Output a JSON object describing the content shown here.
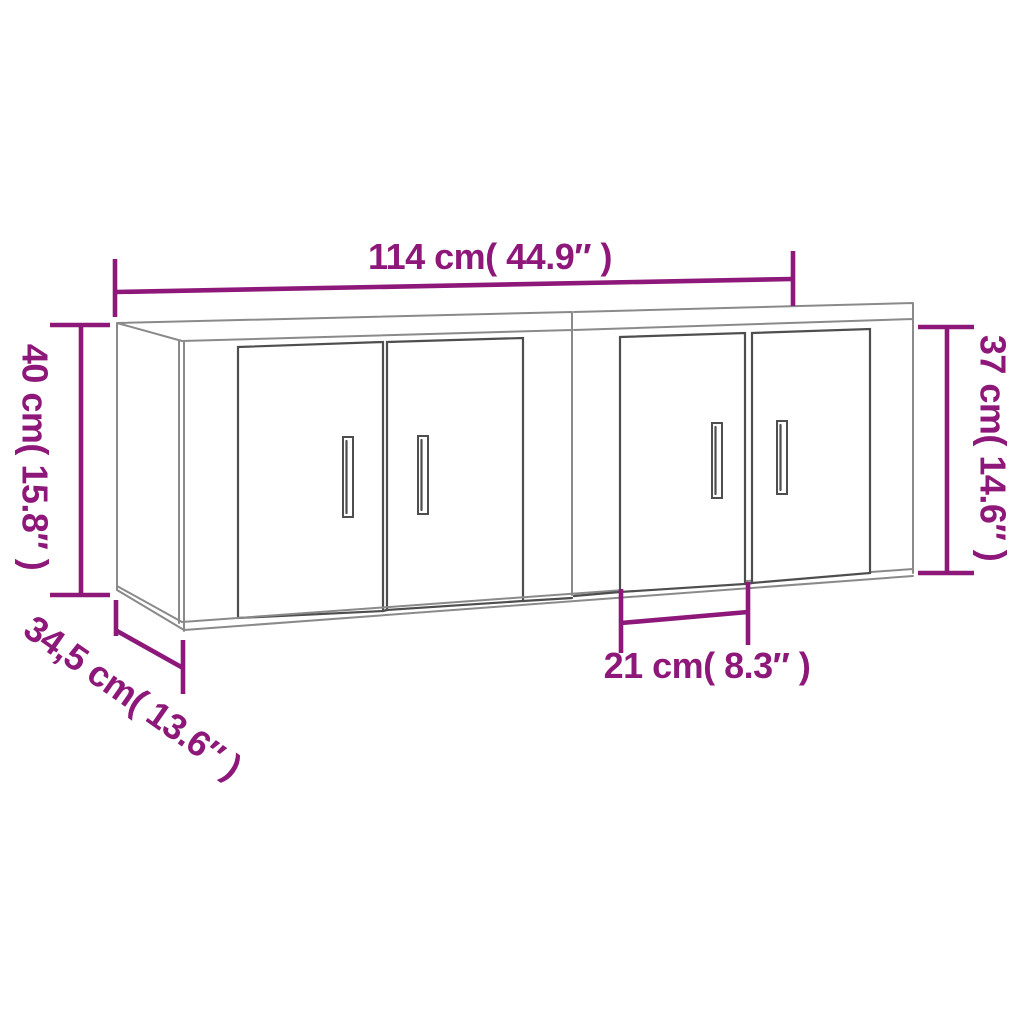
{
  "colors": {
    "background": "#ffffff",
    "dimension_accent": "#8E1879",
    "outline_light": "#8a8a8a",
    "outline_dark": "#4e4e4e"
  },
  "dimensions": {
    "total_width": "114 cm( 44.9″ )",
    "left_height": "40 cm( 15.8″ )",
    "right_height": "37 cm( 14.6″ )",
    "depth": "34,5 cm( 13.6″ )",
    "door_width": "21 cm( 8.3″ )"
  }
}
